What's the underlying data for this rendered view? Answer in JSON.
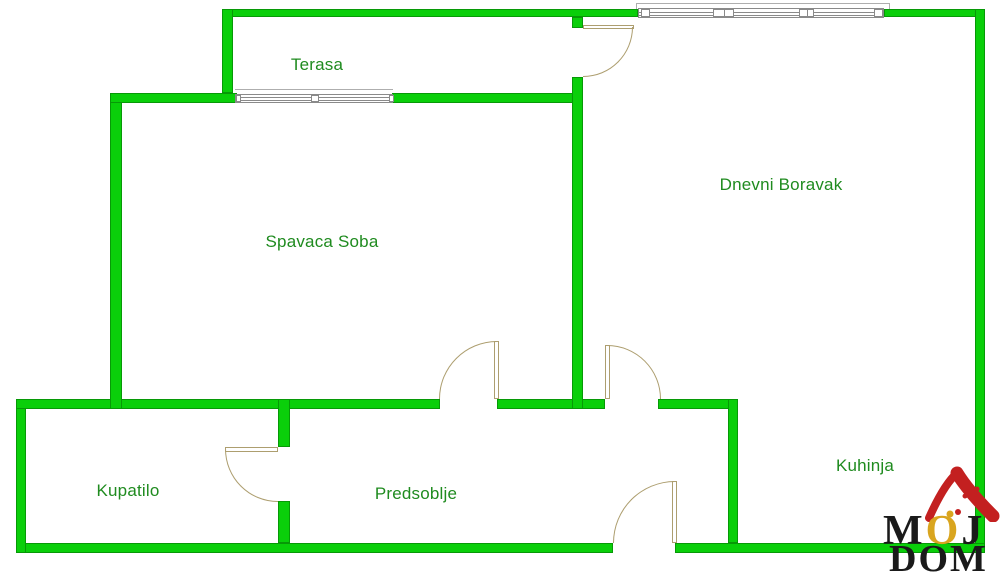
{
  "colors": {
    "wall": "#0acf0a",
    "wall_edge": "#079907",
    "label": "#1f8b1f",
    "door": "#ad9e6f",
    "window": "#8a8a8a",
    "sill": "#9a9a9a",
    "logo_red": "#c32020",
    "logo_yellow": "#d9a51f",
    "logo_black": "#1a1a1a"
  },
  "rooms": {
    "terasa": {
      "label": "Terasa"
    },
    "spavaca_soba": {
      "label": "Spavaca Soba"
    },
    "dnevni_boravak": {
      "label": "Dnevni Boravak"
    },
    "kupatilo": {
      "label": "Kupatilo"
    },
    "predsoblje": {
      "label": "Predsoblje"
    },
    "kuhinja": {
      "label": "Kuhinja"
    }
  },
  "logo": {
    "m": "M",
    "o": "O",
    "j": "J",
    "dom": "DOM"
  }
}
